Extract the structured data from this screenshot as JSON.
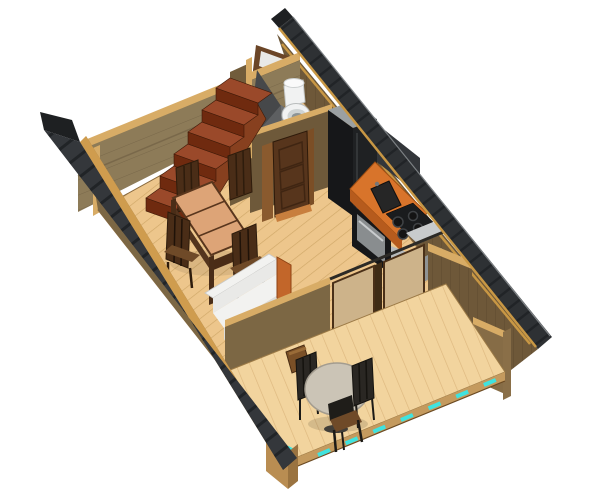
{
  "canvas": {
    "width": 600,
    "height": 500,
    "background": "#ffffff"
  },
  "view": {
    "type": "isometric-cutaway-3d-render",
    "subject": "small cabin / holiday house interior, roof removed, seen from above at an angle",
    "orientation": "building rotated diagonally, gable roof edges visible top-right and bottom-left"
  },
  "palette": {
    "background": "#ffffff",
    "floor": "#edc68c",
    "floorLines": "#cfa768",
    "porchFloor": "#f2d49e",
    "porchFloorLines": "#ddb77e",
    "roof": "#2e3134",
    "roofL": "#34373b",
    "roofLines": "#212427",
    "roofTrim": "#cf9c4e",
    "roofTrimR": "#c89744",
    "wallOlive": "#8d7b58",
    "wallOliveLine": "#79684a",
    "wallBrown": "#6e5839",
    "wallBrownLine": "#5d4a2e",
    "wallMid": "#7c6744",
    "wallLight": "#866c46",
    "wallCap": "#d8ac66",
    "stairTread": "#9a492a",
    "stairRiser": "#6f2a0f",
    "stairSide": "#87401f",
    "tableTop": "#dda477",
    "woodDark": "#4a2d17",
    "woodSeat": "#6f4a28",
    "sofa": "#f2f2f0",
    "sofaShade": "#dcdcda",
    "sofaFront": "#e9e9e7",
    "armOrange": "#c2662a",
    "counterTop": "#d8742b",
    "counterFront": "#b65b1d",
    "appliance": "#161719",
    "applianceEdge": "#33363a",
    "steelGray": "#9ba0a2",
    "steelLight": "#b7babb",
    "ovenGray": "#898d8f",
    "partitionA": "#46484a",
    "partitionB": "#5d5f61",
    "partitionC": "#6f7173",
    "porcelain": "#f1f2f2",
    "porcelainShade": "#cfd4d4",
    "glassPane": "#cdb38a",
    "glassWhite": "#e9e9e7",
    "frameBrown": "#6b4527",
    "doorBrown": "#57351c",
    "doorPanel": "#3f2512",
    "accentCyan": "#3fe3df",
    "tableRound": "#cbc4b6",
    "chairBlack": "#2a2723",
    "fascia": "#c49a5e",
    "post": "#b98d52"
  },
  "scene": {
    "rooms": [
      {
        "name": "bathroom",
        "position": "top corner",
        "items": [
          "white toilet",
          "gray corner shower partition",
          "wall shower fixture",
          "small roof window",
          "dark paneled door"
        ]
      },
      {
        "name": "staircase",
        "position": "upper left along wall",
        "items": [
          "red-brown winder stairs, 6 steps plus landing"
        ]
      },
      {
        "name": "living-dining room",
        "position": "center",
        "items": [
          "rectangular dining table with 3-plank top",
          "4 dark wooden chairs",
          "white two-seat sofa with orange wood arm"
        ]
      },
      {
        "name": "kitchen",
        "position": "right of center against wall",
        "items": [
          "black refrigerator with gray top",
          "orange counter with dark sink",
          "black cooktop with 4 burners",
          "gray oven / end cabinet"
        ]
      },
      {
        "name": "porch / sunroom",
        "position": "bottom",
        "items": [
          "glazed partition wall with wood mullions",
          "round pedestal table",
          "3 dark metal-frame chairs",
          "small wooden stool",
          "cyan edge markers along open deck edge"
        ]
      }
    ],
    "roof": "dark gray shingled eave strips with tan fascia trim remain along both long sides"
  }
}
